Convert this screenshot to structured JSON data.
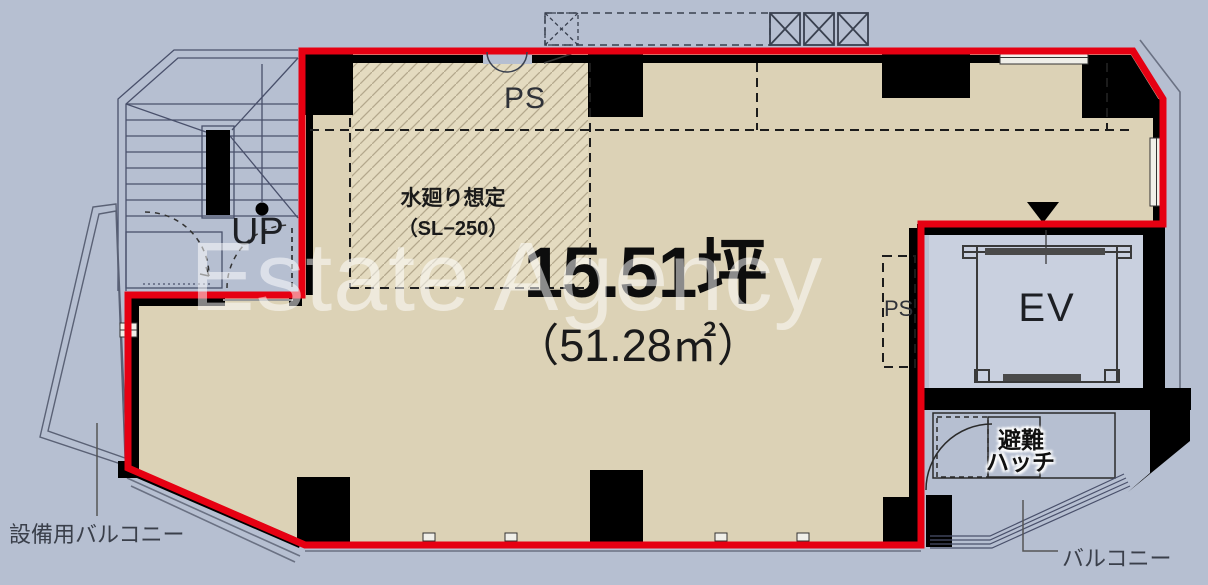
{
  "plan": {
    "title_area_tsubo": "15.51坪",
    "title_area_m2": "（51.28㎡）",
    "wet_area_note_line1": "水廻り想定",
    "wet_area_note_line2": "（SL−250）",
    "pipe_shaft_top": "PS",
    "pipe_shaft_right": "PS",
    "stairs_direction": "UP",
    "elevator": "EV",
    "escape_hatch_line1": "避難",
    "escape_hatch_line2": "ハッチ",
    "balcony_right": "バルコニー",
    "balcony_equipment": "設備用バルコニー",
    "watermark": "Estate Agency"
  },
  "colors": {
    "background": "#b6bfd1",
    "floor": "#dcd2b6",
    "hatch_fill": "#e4dbc0",
    "hatch_line": "#b3a88c",
    "outline_red": "#e60012",
    "wall_black": "#000000",
    "elevator_interior": "#c9d0df",
    "watermark_white": "#ffffff"
  }
}
